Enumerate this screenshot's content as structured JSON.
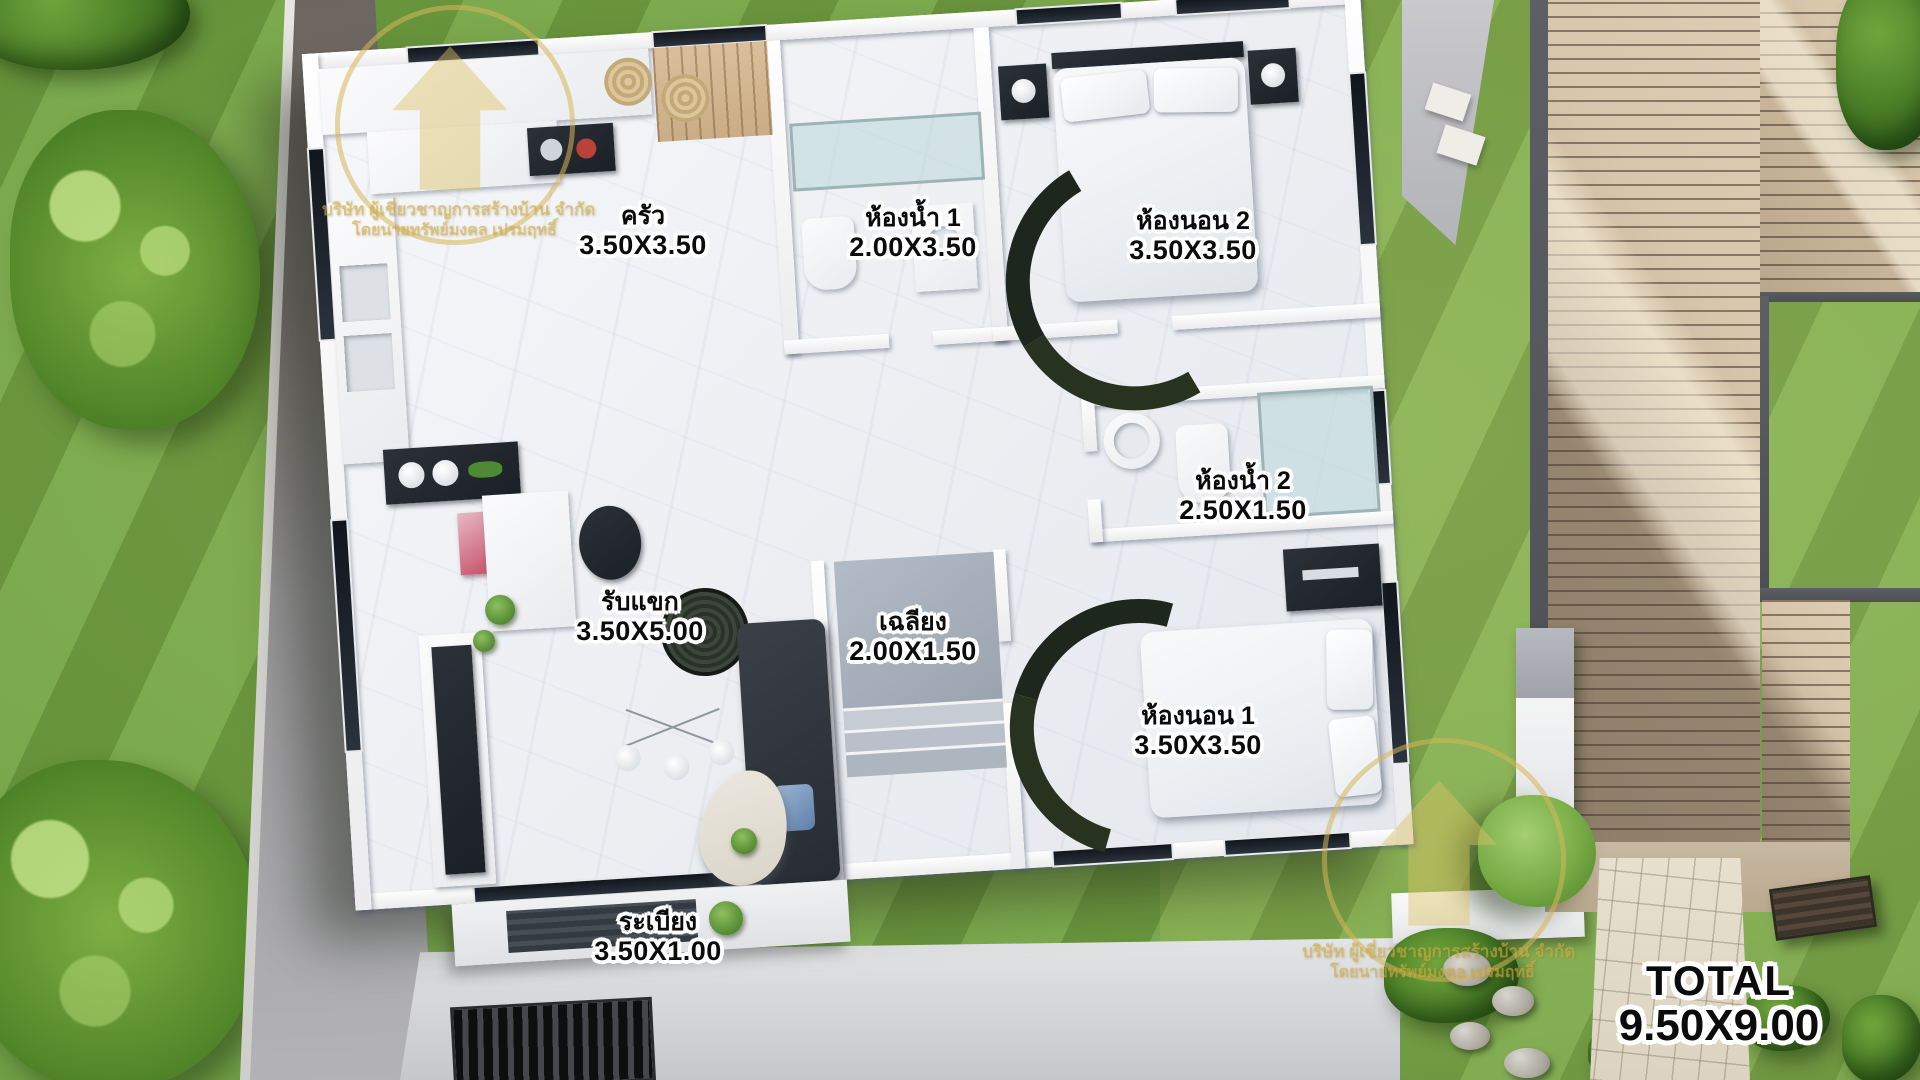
{
  "scene": {
    "type": "house-floor-plan-top-view-render"
  },
  "rooms": [
    {
      "id": "kitchen",
      "name": "ครัว",
      "size": "3.50X3.50"
    },
    {
      "id": "bathroom1",
      "name": "ห้องน้ำ 1",
      "size": "2.00X3.50"
    },
    {
      "id": "bedroom2",
      "name": "ห้องนอน 2",
      "size": "3.50X3.50"
    },
    {
      "id": "bathroom2",
      "name": "ห้องน้ำ 2",
      "size": "2.50X1.50"
    },
    {
      "id": "living",
      "name": "รับแขก",
      "size": "3.50X5.00"
    },
    {
      "id": "porch",
      "name": "เฉลียง",
      "size": "2.00X1.50"
    },
    {
      "id": "bedroom1",
      "name": "ห้องนอน 1",
      "size": "3.50X3.50"
    },
    {
      "id": "terrace",
      "name": "ระเบียง",
      "size": "3.50X1.00"
    }
  ],
  "total": {
    "label": "TOTAL",
    "size": "9.50X9.00"
  },
  "watermark": {
    "line1": "บริษัท ผู้เชี่ยวชาญการสร้างบ้าน จำกัด",
    "line2": "โดยนายทรัพย์มงคล เปรมฤทธิ์"
  },
  "colors": {
    "grass": "#74a543",
    "deck": "#c7b499",
    "house_floor": "#eef0f4",
    "wall": "#fdfdfd",
    "accent_dark": "#262b31",
    "label_text": "#0b0b0b",
    "label_outline": "#ffffff",
    "watermark_gold": "#d6b75a"
  }
}
